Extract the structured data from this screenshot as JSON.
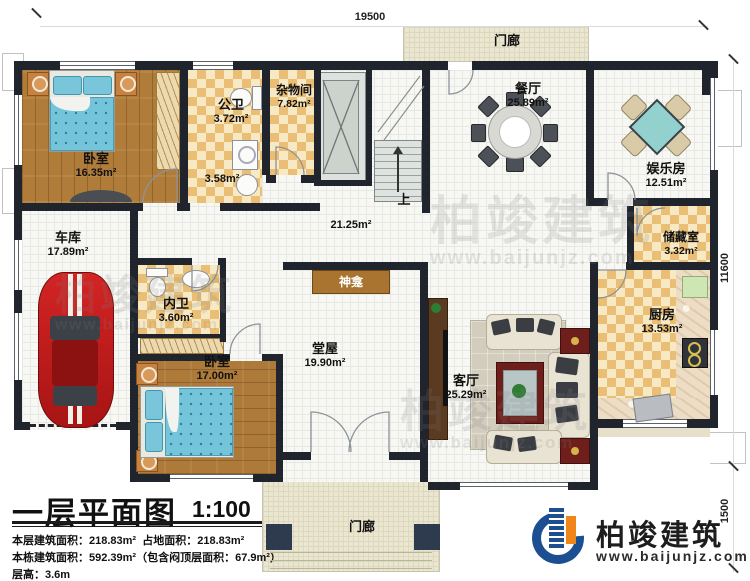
{
  "dimensions": {
    "top": "19500",
    "right_upper": "11600",
    "right_lower": "1500"
  },
  "rooms": {
    "bedroom1": {
      "name": "卧室",
      "area": "16.35m²"
    },
    "gongwei": {
      "name": "公卫",
      "area": "3.72m²"
    },
    "small_area": {
      "area": "3.58m²"
    },
    "zawujian": {
      "name": "杂物间",
      "area": "7.82m²"
    },
    "dining": {
      "name": "餐厅",
      "area": "25.89m²"
    },
    "entertainment": {
      "name": "娱乐房",
      "area": "12.51m²"
    },
    "storage": {
      "name": "储藏室",
      "area": "3.32m²"
    },
    "kitchen": {
      "name": "厨房",
      "area": "13.53m²"
    },
    "garage": {
      "name": "车库",
      "area": "17.89m²"
    },
    "neiwei": {
      "name": "内卫",
      "area": "3.60m²"
    },
    "bedroom2": {
      "name": "卧室",
      "area": "17.00m²"
    },
    "tangwu": {
      "name": "堂屋",
      "area": "19.90m²"
    },
    "living": {
      "name": "客厅",
      "area": "25.29m²"
    },
    "hall": {
      "area": "21.25m²"
    },
    "shrine": {
      "name": "神龛"
    },
    "stairs": {
      "up_label": "上"
    },
    "porch_top": {
      "name": "门廊"
    },
    "porch_bottom": {
      "name": "门廊"
    }
  },
  "title_block": {
    "title": "一层平面图",
    "scale": "1:100",
    "line1a": "本层建筑面积：218.83m²",
    "line1b": "占地面积：218.83m²",
    "line2": "本栋建筑面积：592.39m²（包含闷顶层面积：67.9m²）",
    "line3": "层高：3.6m"
  },
  "logo": {
    "company": "柏竣建筑",
    "website": "www.baijunjz.com"
  },
  "watermark": {
    "text": "柏竣建筑",
    "site": "www.baijunjz.com"
  },
  "colors": {
    "wall": "#20242d",
    "wood": "#b07c3a",
    "checker": "#eabf75",
    "porch": "#ebe6d0",
    "brand_blue": "#1c4e92",
    "brand_orange": "#f08519",
    "bed_blue": "#74c4da",
    "car_red": "#c11c1c"
  }
}
